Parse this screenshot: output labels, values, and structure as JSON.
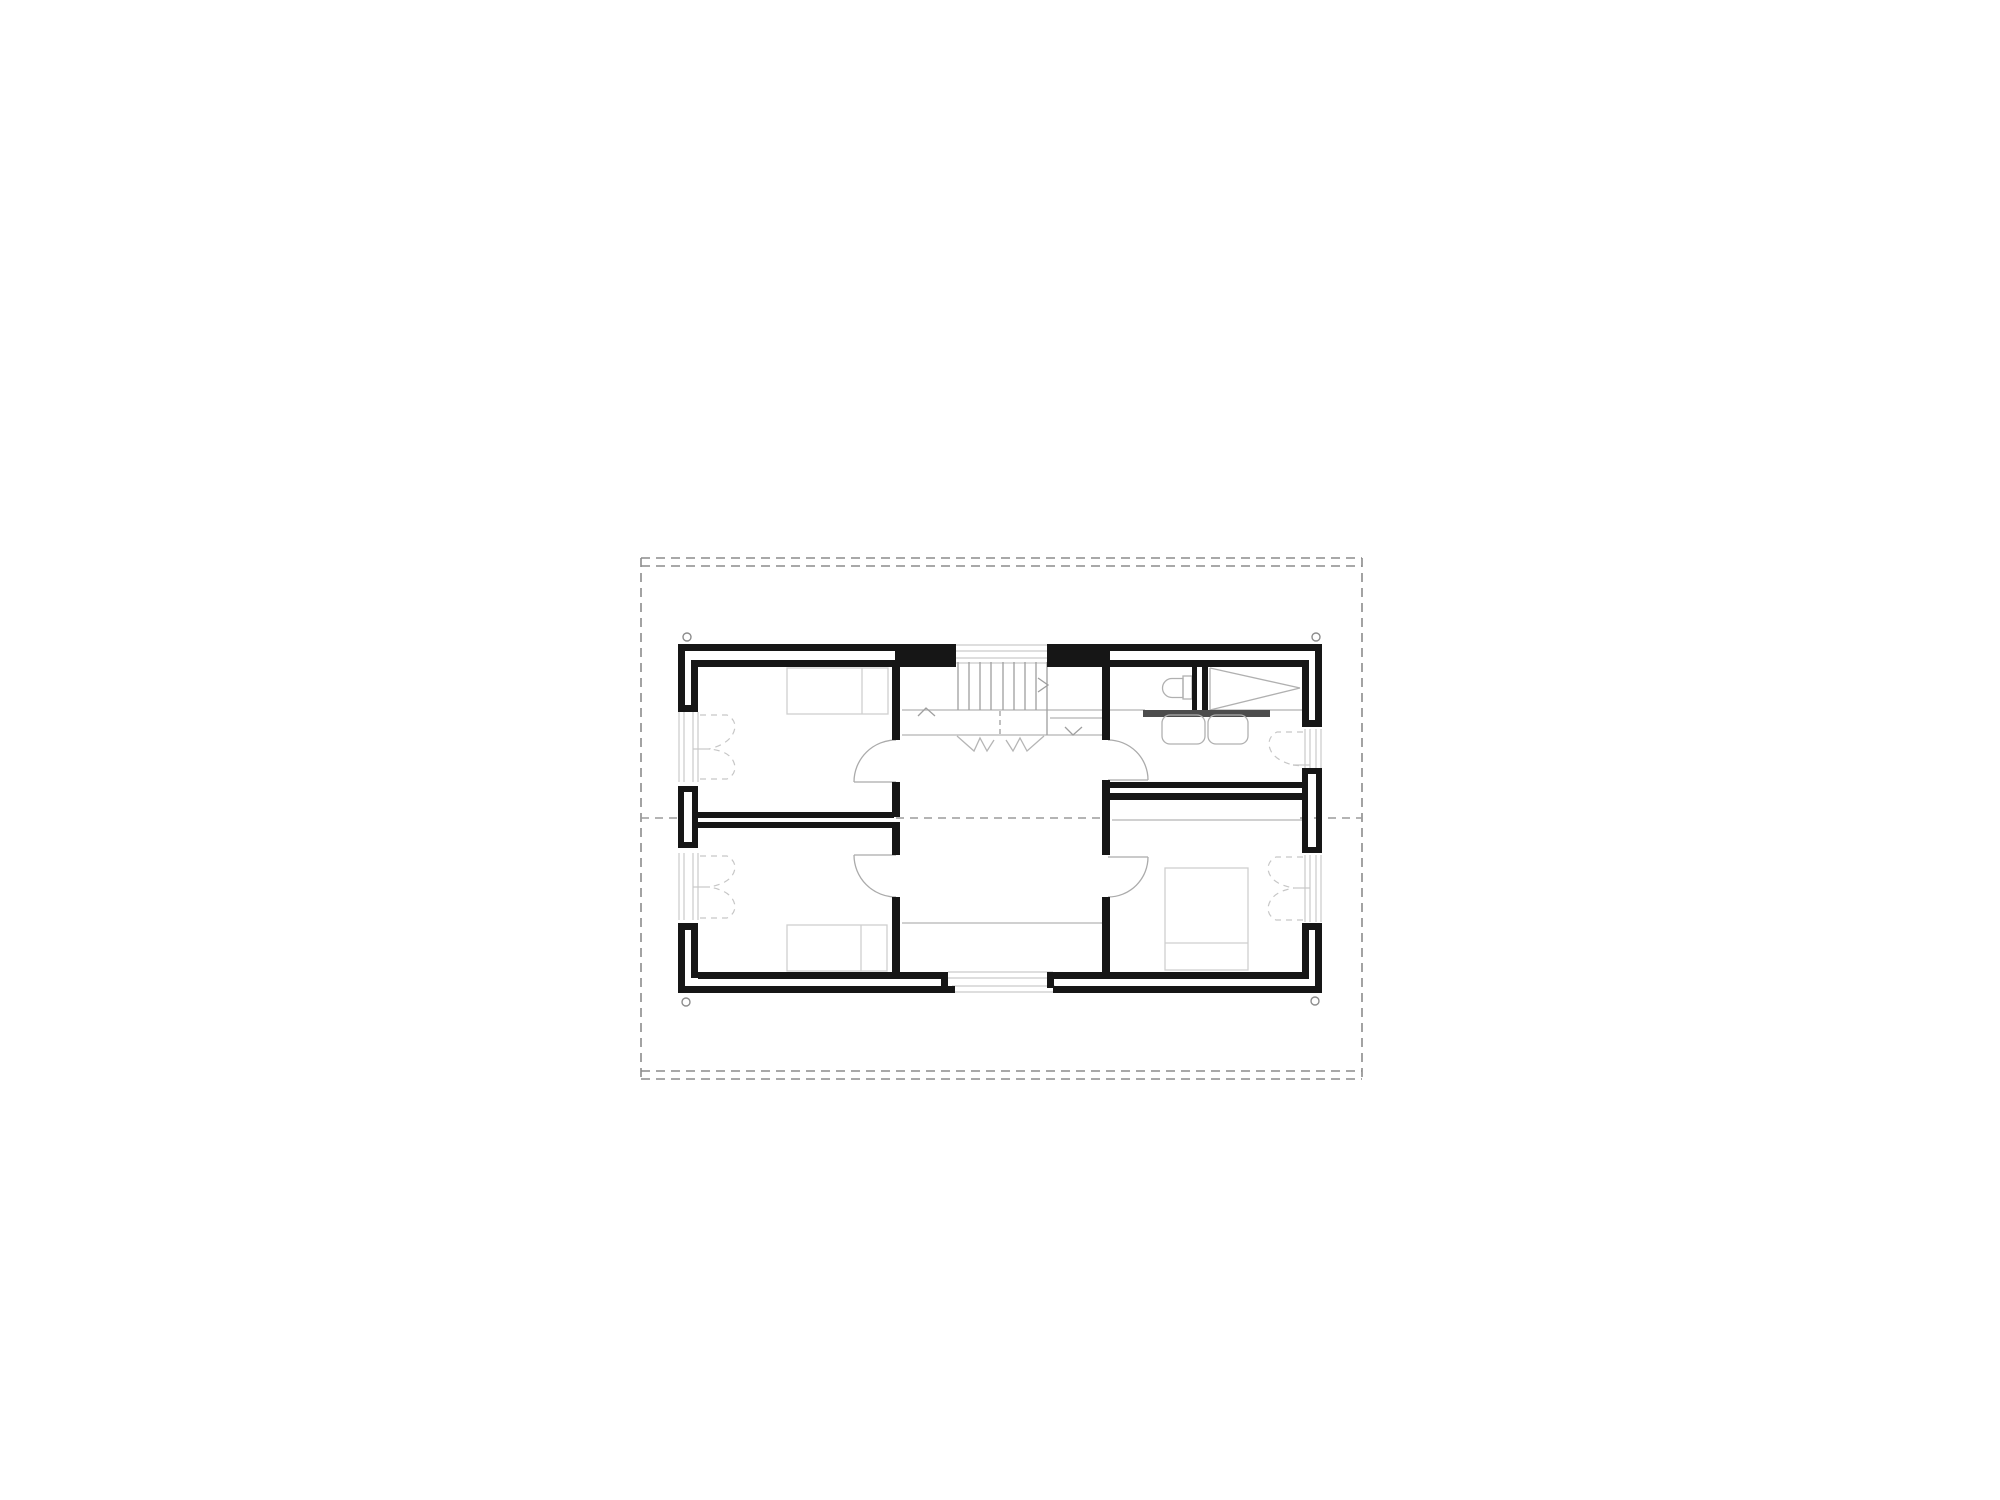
{
  "drawing": {
    "type": "architectural-floor-plan-upper-level",
    "visible_text": [],
    "colors": {
      "background": "#ffffff",
      "walls": "#161616",
      "roof_outline_dashes": "#8c8c8c",
      "ridge_line_dashes": "#9c9c9c",
      "thin_cladding_lines": "#c9c9c9",
      "fixture_lines": "#b0b0b0",
      "bed_lines": "#cfcfcf",
      "door_swing_lines": "#ababab",
      "dashed_casement_lines": "#c6c6c6",
      "counter_fill": "#4d4d4d"
    },
    "roof": {
      "overhang_outline": "dashed rectangle around building",
      "eaves_edges": "double dashed lines top and bottom",
      "gable_edges": "single dashed lines left and right",
      "ridge_line": "dashed horizontal centre line",
      "corner_drain_circles": 4
    },
    "rooms": [
      {
        "id": "bedroom-top-left",
        "furniture": [
          "single-bed-with-pillow"
        ],
        "windows": 1,
        "doors": 1
      },
      {
        "id": "bedroom-bottom-left",
        "furniture": [
          "single-bed-with-pillow"
        ],
        "windows": 1,
        "doors": 1
      },
      {
        "id": "bathroom-top-right",
        "fixtures": [
          "toilet",
          "shower-with-sloped-floor",
          "counter",
          "sink",
          "sink"
        ],
        "windows": 1,
        "doors": 1
      },
      {
        "id": "bedroom-bottom-right",
        "furniture": [
          "double-bed-with-pillow"
        ],
        "windows": 1,
        "doors": 1
      },
      {
        "id": "hall-landing-centre",
        "features": [
          "staircase",
          "upper-landing",
          "void-edge-line",
          "window-south",
          "window-above-stair"
        ]
      }
    ],
    "staircase": {
      "treads": 8,
      "direction_chevrons": [
        "up",
        "right",
        "down"
      ],
      "centre_line": "dashed",
      "break_line": "zigzag"
    },
    "window_symbols": "dashed inward-opening casement leaves",
    "door_symbols": "quarter-circle swing arcs with open leaf line"
  }
}
